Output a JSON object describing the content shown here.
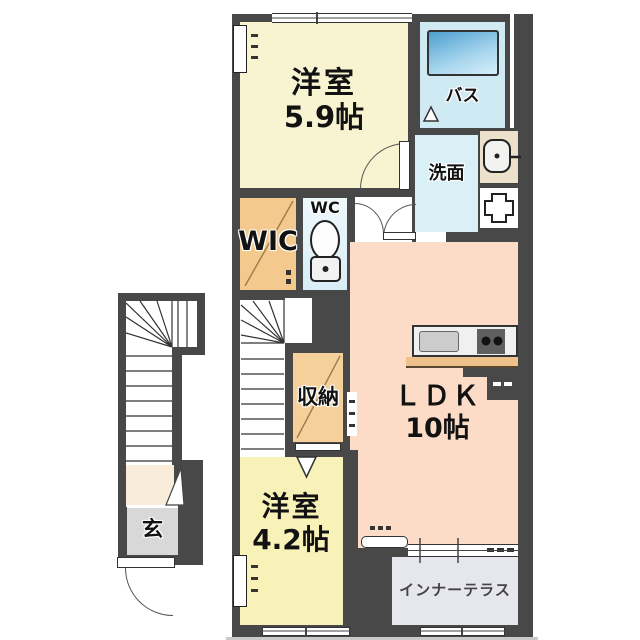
{
  "floorplan": {
    "type": "japanese-apartment-floor-plan",
    "rooms": {
      "bedroom_main": {
        "label": "洋室",
        "size": "5.9帖",
        "color": "#f8f3d0"
      },
      "bath": {
        "label": "バス",
        "color": "#cfeaf3",
        "tub_color": "#4e9fd0"
      },
      "washroom": {
        "label": "洗面",
        "color": "#d9f0f7"
      },
      "wic": {
        "label": "WIC",
        "color": "#f3c98e"
      },
      "wc": {
        "label": "WC",
        "color": "#e3f3f9"
      },
      "storage": {
        "label": "収納",
        "color": "#f5d09a"
      },
      "ldk": {
        "label": "ＬＤＫ",
        "size": "10帖",
        "color": "#fcdcc6"
      },
      "bedroom_second": {
        "label": "洋室",
        "size": "4.2帖",
        "color": "#f8f2b8"
      },
      "inner_terrace": {
        "label": "インナーテラス",
        "color": "#e6e6ef"
      },
      "entrance": {
        "label": "玄",
        "color": "#d8d8d8"
      }
    },
    "colors": {
      "wall": "#484848",
      "background": "#ffffff",
      "counter_edge": "#eec28a",
      "stairs": "#ffffff",
      "diagonal_line": "#9c7c4c"
    },
    "fixtures": [
      "bathtub",
      "washbasin-icon",
      "washing-machine-icon",
      "toilet-icon",
      "kitchen-counter",
      "kitchen-sink",
      "stove-burners",
      "refrigerator-space",
      "staircase-internal",
      "staircase-external",
      "entry-door-arc",
      "sliding-windows",
      "door-arcs"
    ]
  }
}
